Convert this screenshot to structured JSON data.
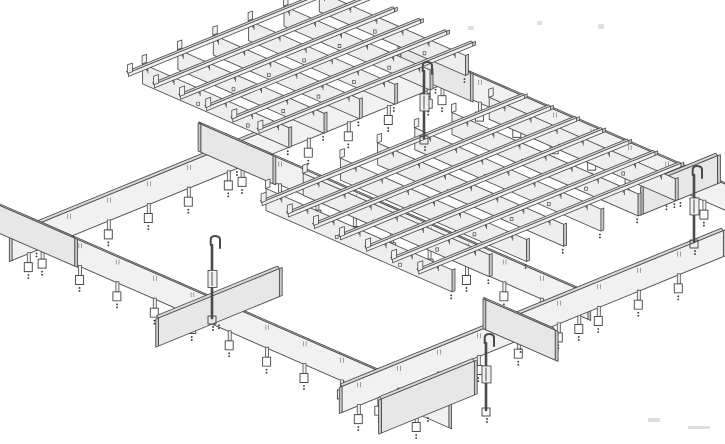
{
  "figure": {
    "description": "Isometric technical line drawing of a suspended open-cell ceiling grid system: perimeter main runners and cross runners with hanger clips, four vertical suspension hooks, short cross-tee stub plates, and two square-cell open grid panel assemblies"
  },
  "colors": {
    "line": "#4a4a4a",
    "line_soft": "#7a7a7a",
    "face": "#f1f1f1",
    "face_shaded": "#e7e7e7",
    "blade_face": "#eeeeee",
    "top_face": "#d8d8d8",
    "end_cap": "#c7c7c7",
    "dot": "#3f3f3f",
    "artifact": "#cccccc",
    "background": "#ffffff"
  },
  "projection": {
    "origin": [
      40,
      245
    ],
    "axis_a": [
      0.93,
      -0.38
    ],
    "axis_b": [
      0.87,
      0.38
    ]
  },
  "runners": [
    {
      "name": "back-main-runner",
      "dir": "a",
      "fixed": 0,
      "from": -30,
      "to": 435,
      "height": 26,
      "clip_step": 43
    },
    {
      "name": "right-cross-runner",
      "dir": "b",
      "fixed": 430,
      "from": -15,
      "to": 380,
      "height": 26,
      "clip_step": 43
    },
    {
      "name": "mid-cross-runner",
      "dir": "b",
      "fixed": 215,
      "from": -15,
      "to": 400,
      "height": 26,
      "clip_step": 43
    },
    {
      "name": "left-cross-runner",
      "dir": "b",
      "fixed": 0,
      "from": -15,
      "to": 470,
      "height": 26,
      "clip_step": 43
    },
    {
      "name": "front-main-runner",
      "dir": "a",
      "fixed": 390,
      "from": -40,
      "to": 370,
      "height": 26,
      "clip_step": 43
    }
  ],
  "stubs": [
    {
      "name": "cross-tee-stub-corner",
      "dir": "b",
      "fixed": 0,
      "from": -48,
      "to": 40,
      "height": 28,
      "dy": 0
    },
    {
      "name": "cross-tee-stub-back-mid",
      "dir": "b",
      "fixed": 215,
      "from": -45,
      "to": 38,
      "height": 28,
      "dy": 0
    },
    {
      "name": "cross-tee-stub-top-corner",
      "dir": "b",
      "fixed": 430,
      "from": -45,
      "to": 35,
      "height": 28,
      "dy": 0
    },
    {
      "name": "cross-tee-stub-left-mid",
      "dir": "a",
      "fixed": 195,
      "from": -55,
      "to": 75,
      "height": 28,
      "dy": 0
    },
    {
      "name": "cross-tee-stub-right",
      "dir": "a",
      "fixed": 285,
      "from": 382,
      "to": 462,
      "height": 28,
      "dy": 0
    },
    {
      "name": "cross-tee-stub-bottom-left",
      "dir": "a",
      "fixed": 448,
      "from": -52,
      "to": 48,
      "height": 34,
      "dy": -14
    },
    {
      "name": "cross-tee-stub-bottom-front",
      "dir": "b",
      "fixed": 150,
      "from": 352,
      "to": 432,
      "height": 30,
      "dy": 0
    }
  ],
  "clusters": [
    {
      "name": "grid-cluster-left",
      "rails": {
        "v": [
          -155,
          -125,
          -95,
          -65,
          -35,
          -5
        ],
        "u0": 240,
        "u1": 470
      },
      "blades": {
        "u": [
          260,
          298,
          336,
          374,
          412,
          450
        ],
        "v0": -160,
        "v1": 8,
        "h": 20
      }
    },
    {
      "name": "grid-cluster-right",
      "rails": {
        "v": [
          95,
          125,
          155,
          185,
          215,
          245,
          275
        ],
        "u0": 150,
        "u1": 432
      },
      "blades": {
        "u": [
          170,
          210,
          250,
          290,
          330,
          370,
          410
        ],
        "v0": 78,
        "v1": 292,
        "h": 22
      }
    }
  ],
  "hooks": [
    {
      "name": "hanger-hook-left",
      "x": 212,
      "top": 236,
      "bottom": 318
    },
    {
      "name": "hanger-hook-top",
      "x": 424,
      "top": 62,
      "bottom": 138
    },
    {
      "name": "hanger-hook-bottom",
      "x": 486,
      "top": 334,
      "bottom": 410
    },
    {
      "name": "hanger-hook-right",
      "x": 694,
      "top": 166,
      "bottom": 242
    }
  ],
  "artifacts": [
    {
      "x": 468,
      "y": 26,
      "w": 6,
      "h": 4
    },
    {
      "x": 537,
      "y": 21,
      "w": 5,
      "h": 4
    },
    {
      "x": 598,
      "y": 24,
      "w": 6,
      "h": 5
    },
    {
      "x": 648,
      "y": 418,
      "w": 12,
      "h": 4
    },
    {
      "x": 688,
      "y": 426,
      "w": 22,
      "h": 3
    }
  ]
}
